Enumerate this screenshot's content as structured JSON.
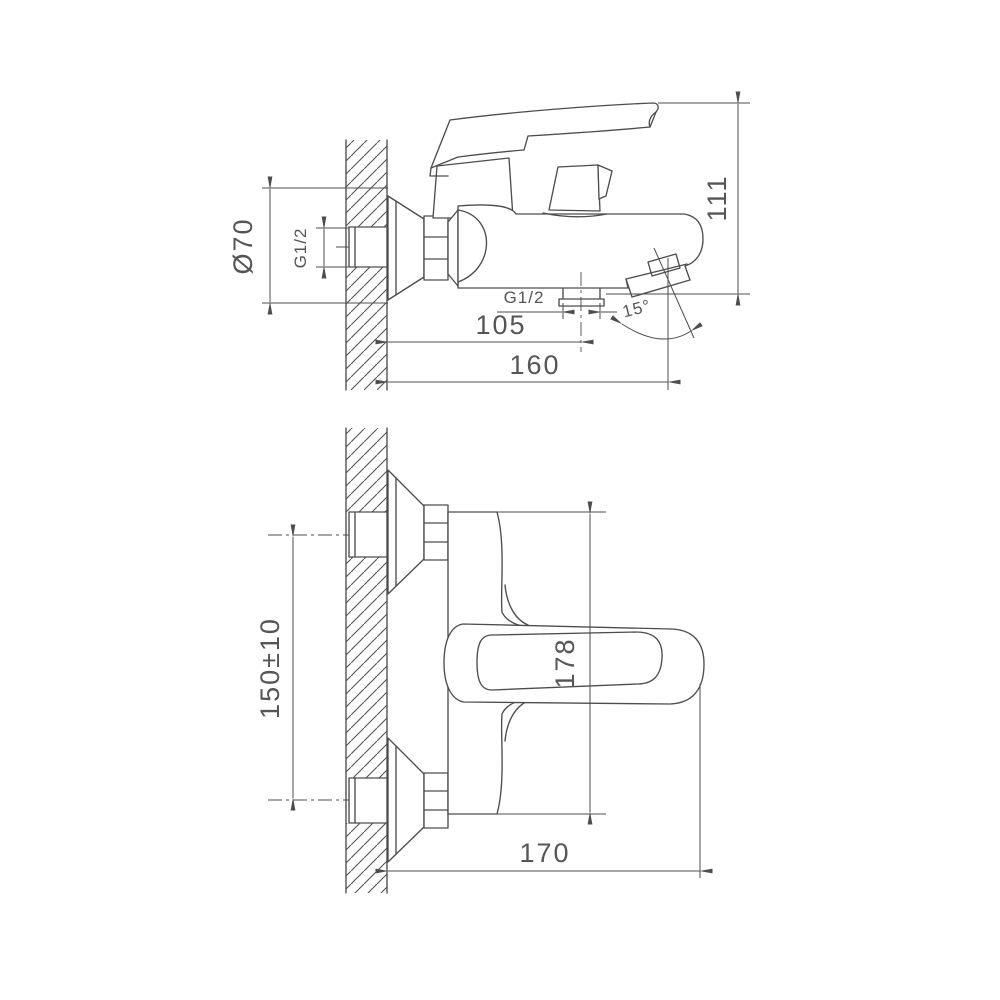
{
  "style": {
    "line_color": "#4d4d4d",
    "text_color": "#555555",
    "background": "#ffffff"
  },
  "side_view": {
    "dims": {
      "escutcheon_diameter": "Ø70",
      "inlet_thread": "G1/2",
      "overall_height": "111",
      "shower_outlet_thread": "G1/2",
      "wall_to_outlet_center": "105",
      "wall_to_spout_end": "160",
      "outlet_angle": "15°"
    }
  },
  "plan_view": {
    "dims": {
      "mounting_centers": "150±10",
      "overall_depth": "178",
      "spout_projection": "170"
    }
  }
}
